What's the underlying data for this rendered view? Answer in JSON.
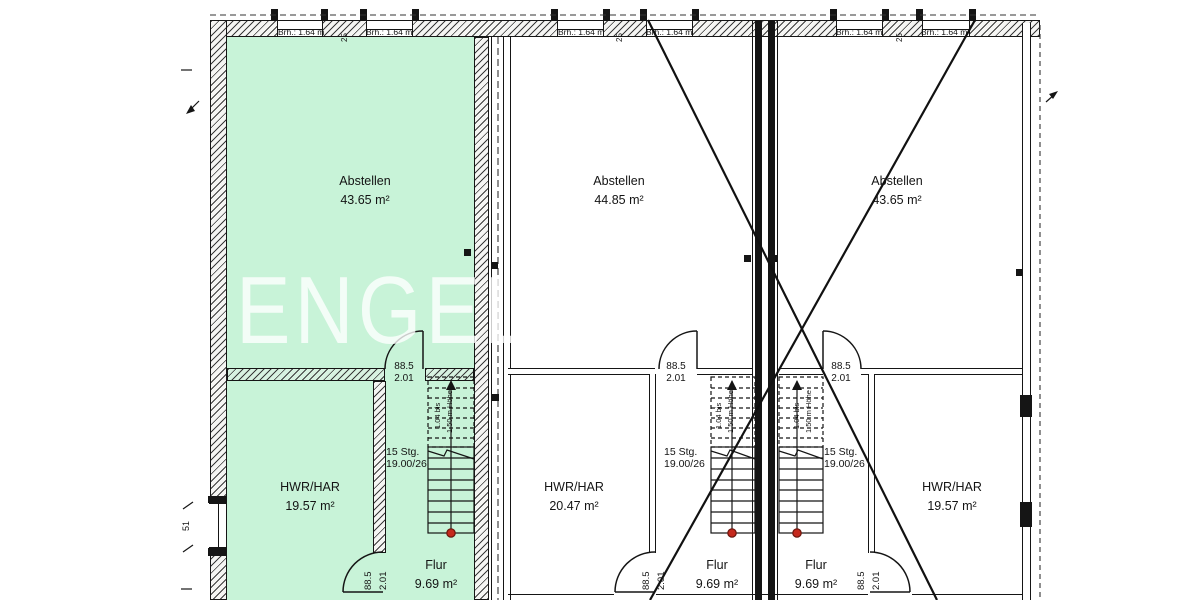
{
  "watermark": "ENGEL",
  "dimensions": {
    "window_parapet": "Brh.: 1.64 m",
    "window_pier": "25",
    "door_width": "88.5",
    "door_height": "2.01",
    "stairs_count": "15 Stg.",
    "stairs_ratio": "19.00/26",
    "understair_min": "1.04 bis",
    "understair_max": "1.50 m Höhe",
    "side_dim": "51"
  },
  "units": [
    {
      "label": "unit-left-highlighted",
      "rooms": {
        "abstellen": {
          "name": "Abstellen",
          "area": "43.65 m²"
        },
        "hwr": {
          "name": "HWR/HAR",
          "area": "19.57 m²"
        },
        "flur": {
          "name": "Flur",
          "area": "9.69 m²"
        }
      }
    },
    {
      "label": "unit-middle-crossed",
      "rooms": {
        "abstellen": {
          "name": "Abstellen",
          "area": "44.85 m²"
        },
        "hwr": {
          "name": "HWR/HAR",
          "area": "20.47 m²"
        },
        "flur": {
          "name": "Flur",
          "area": "9.69 m²"
        }
      }
    },
    {
      "label": "unit-right-crossed",
      "rooms": {
        "abstellen": {
          "name": "Abstellen",
          "area": "43.65 m²"
        },
        "hwr": {
          "name": "HWR/HAR",
          "area": "19.57 m²"
        },
        "flur": {
          "name": "Flur",
          "area": "9.69 m²"
        }
      }
    }
  ],
  "colors": {
    "highlight_room": "#c8f3d8",
    "stair_start_dot": "#c5291d",
    "wall": "#151515"
  }
}
